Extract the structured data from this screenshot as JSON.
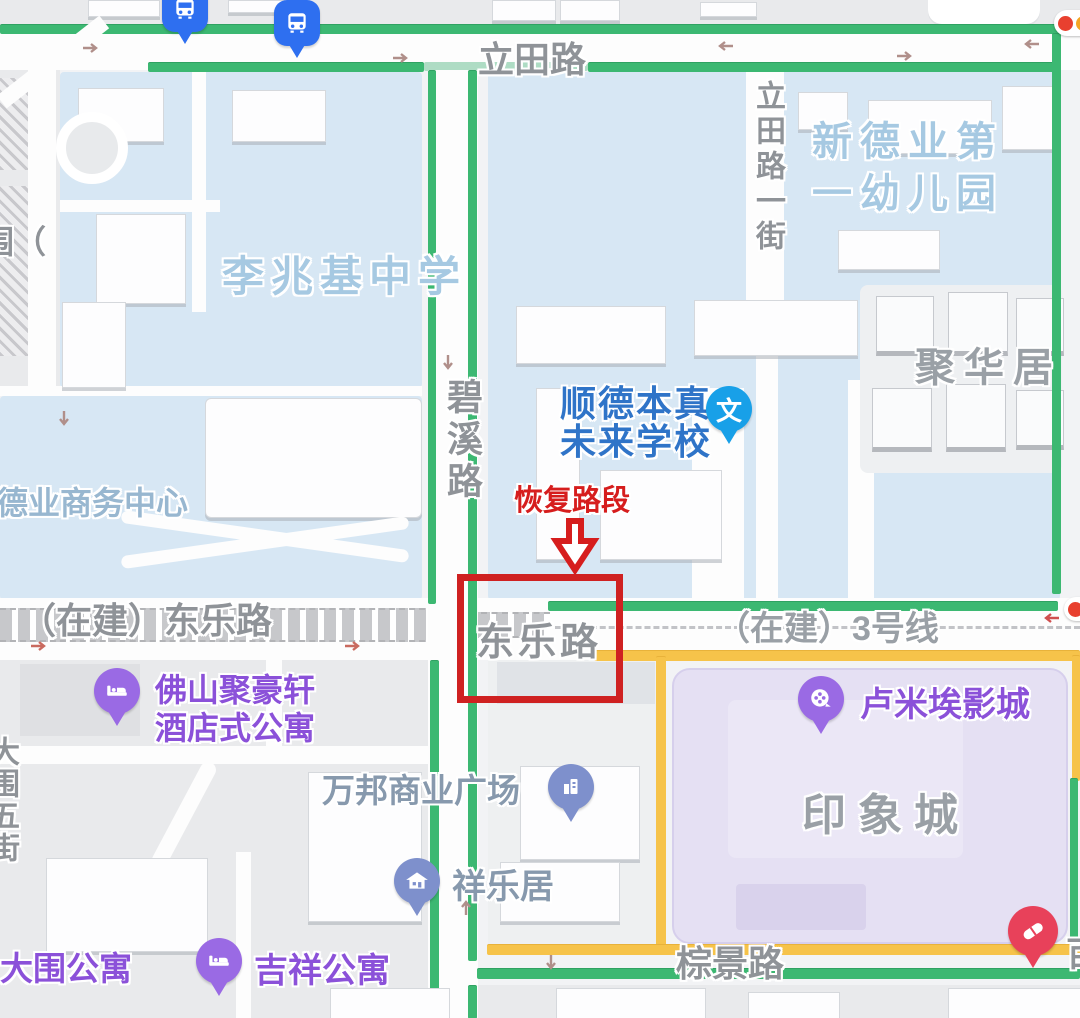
{
  "map": {
    "roads": {
      "litian": "立田路",
      "litian_first_street": "立田路一街",
      "bixi": "碧溪路",
      "dongle_under_construction": "（在建）东乐路",
      "dongle": "东乐路",
      "line3_under_construction": "（在建）3号线",
      "zongjing": "棕景路",
      "dawei_fifth_street": "大围五街",
      "left_edge_partial": "围（",
      "right_edge_partial": "百"
    },
    "places": {
      "xindeye_kindergarten_line1": "新德业第",
      "xindeye_kindergarten_line2": "一幼儿园",
      "lizhaoji_middle_school": "李兆基中学",
      "juhuaju": "聚华居",
      "shunde_benzhen_line1": "顺德本真",
      "shunde_benzhen_line2": "未来学校",
      "deye_business_center": "德业商务中心",
      "juhaoxuan_hotel_line1": "佛山聚豪轩",
      "juhaoxuan_hotel_line2": "酒店式公寓",
      "wanbang_plaza": "万邦商业广场",
      "xiangleju": "祥乐居",
      "dawei_apartment": "大围公寓",
      "jixiang_apartment": "吉祥公寓",
      "lumiere_cinema": "卢米埃影城",
      "yinxiangcheng_mall": "印象城"
    },
    "annotation": {
      "restored_section": "恢复路段"
    },
    "icons": {
      "education_glyph": "文"
    },
    "colors": {
      "road_green": "#3cb872",
      "road_yellow": "#f6c34a",
      "annotation_red": "#d61d1d",
      "school_text_blue": "#2f74c8",
      "area_label_blue": "#a6c9e2",
      "poi_purple": "#8b51d9",
      "road_label_gray": "#8f9398",
      "pin_education_blue": "#18a0e8",
      "pin_bus_blue": "#2e6ff0",
      "pin_residence_slate": "#7e90cc",
      "pin_poi_purple": "#9a6ae4",
      "pin_pharmacy_red": "#e8415a"
    }
  }
}
